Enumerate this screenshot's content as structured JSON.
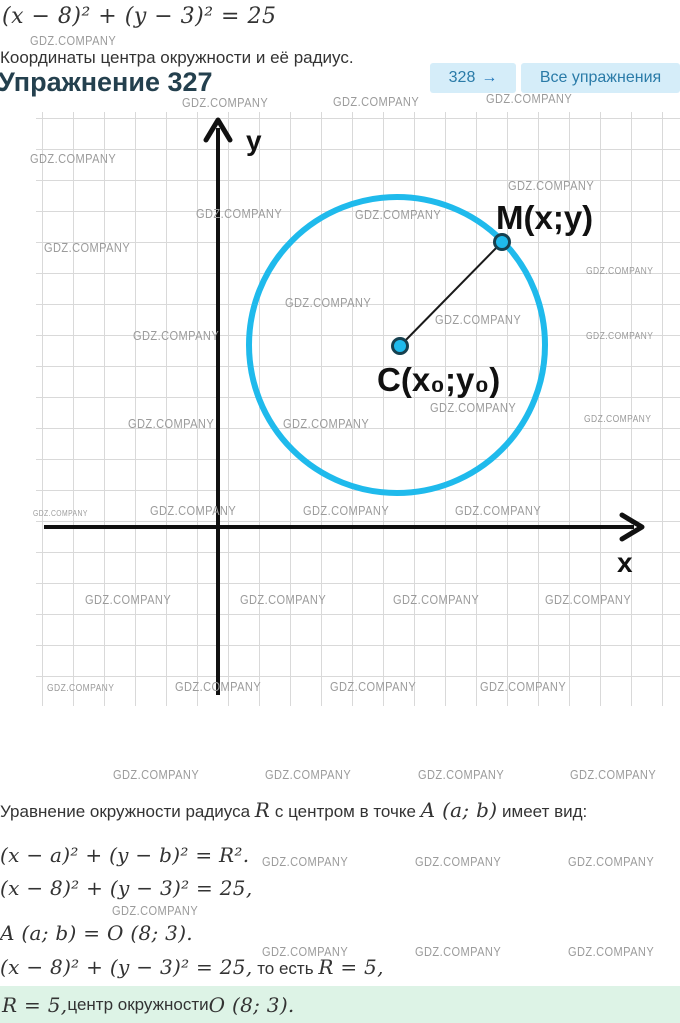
{
  "watermark": "GDZ.COMPANY",
  "header": {
    "formula": "(x − 8)² + (y − 3)² = 25",
    "subtitle": "Координаты центра окружности и её радиус.",
    "title": "Упражнение 327",
    "next_exercise": "328",
    "next_arrow": "→",
    "all_exercises": "Все упражнения"
  },
  "graph": {
    "y_axis_label": "y",
    "x_axis_label": "x",
    "point_m_label": "M(x;y)",
    "point_c_label": "C(x₀;y₀)"
  },
  "solution": {
    "intro": {
      "t1": "Уравнение окружности радиуса ",
      "m1": "R",
      "t2": " с центром в точке ",
      "m2": "A (a; b)",
      "t3": " имеет вид:"
    },
    "eq_general": "(x − a)² + (y − b)² = R².",
    "eq_specific": "(x − 8)² + (y − 3)² = 25,",
    "eq_center": "A (a; b) = O (8; 3).",
    "conclusion": {
      "m1": "(x − 8)² + (y − 3)² = 25,",
      "t1": " то есть ",
      "m2": "R = 5,"
    }
  },
  "answer": {
    "m1": "R = 5,",
    "t1": " центр окружности ",
    "m2": "O (8; 3)."
  },
  "colors": {
    "accent_cyan": "#1fbaec",
    "point_stroke": "#16404f",
    "button_bg": "#d5edf9",
    "button_text": "#2a7ba8",
    "heading": "#24404e",
    "text": "#333333",
    "watermark": "#9b9b9b",
    "grid": "#d9d9d9",
    "axis": "#111111",
    "answer_bg": "#ddf3e6"
  }
}
